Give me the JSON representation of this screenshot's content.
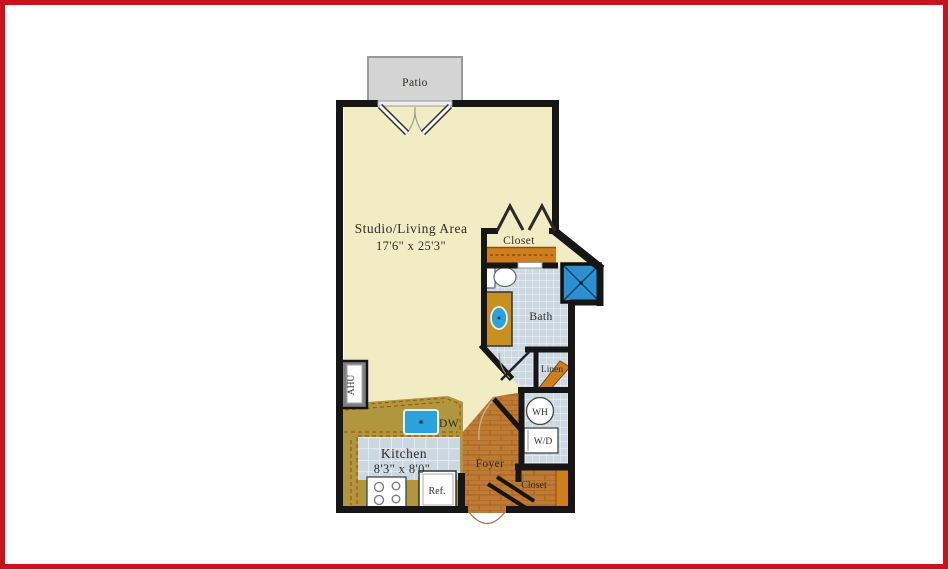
{
  "plan_type": "studio-apartment-floor-plan",
  "colors": {
    "frame_red": "#c9121b",
    "wall_black": "#161616",
    "floor_cream": "#f1ecc3",
    "patio_gray": "#d4d4d4",
    "tile_blue_gray": "#cdd9e2",
    "wood_orange": "#bf7a33",
    "shelf_orange": "#cd7f1e",
    "counter_olive": "#b0973f",
    "shower_blue": "#2b8fd2",
    "sink_blue": "#2aa3dc",
    "ahu_gray": "#808080"
  },
  "rooms": {
    "patio": {
      "label": "Patio"
    },
    "studio": {
      "label": "Studio/Living Area",
      "dimensions": "17'6\" x 25'3\""
    },
    "upper_closet": {
      "label": "Closet"
    },
    "bath": {
      "label": "Bath"
    },
    "linen": {
      "label": "Linen"
    },
    "water_heater": {
      "label": "WH"
    },
    "washer_dryer": {
      "label": "W/D"
    },
    "foyer": {
      "label": "Foyer"
    },
    "entry_closet": {
      "label": "Closet"
    },
    "kitchen": {
      "label": "Kitchen",
      "dimensions": "8'3\" x 8'0\""
    },
    "dishwasher": {
      "label": "DW"
    },
    "refrigerator": {
      "label": "Ref."
    },
    "air_handling_unit": {
      "label": "AHU"
    }
  }
}
